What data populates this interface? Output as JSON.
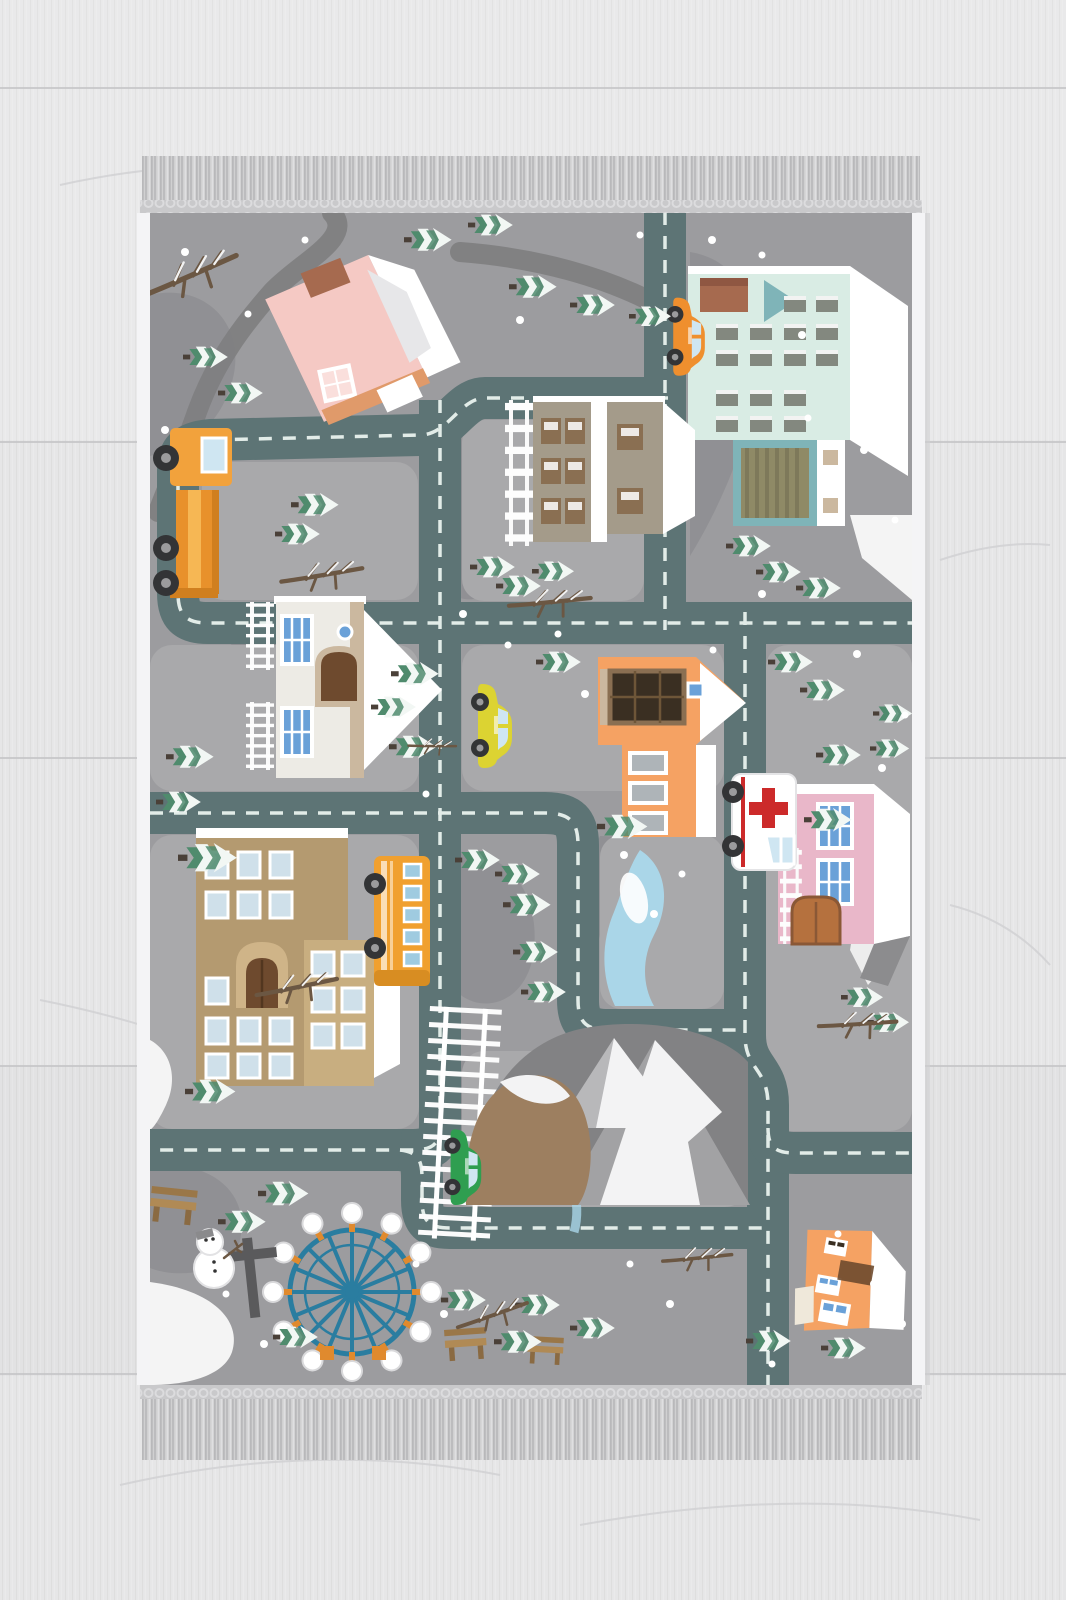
{
  "meta": {
    "scene": "Children's winter town road play rug with tasselled fringe, photographed from above on a light wooden plank floor",
    "image_type": "product-photo",
    "visible_text": "none"
  },
  "palette": {
    "floor": "#e6e6e7",
    "floorLine": "#c6c6c8",
    "grain": "#d0d0d2",
    "fringeBase": "#d0d0d1",
    "fringeDark": "#bcbcbe",
    "fringeLight": "#dfdfe1",
    "knotBand": "#c9c9cb",
    "rugEdge": "#f4f4f6",
    "rugBg": "#9c9c9f",
    "block": "#a9a9ab",
    "terrain": "#86868a",
    "snow": "#f4f4f4",
    "road": "#5d7475",
    "roadDash": "#e2ece8",
    "path": "#7f7f81",
    "treeGreen": "#4f8b6d",
    "treeWhite": "#f2f7f4",
    "trunk": "#4a4038",
    "branch": "#6b5743",
    "pinkHouse": "#f5c9c4",
    "pinkRoof": "#fadfdc",
    "trim": "#e09a6a",
    "chimney": "#a66a4f",
    "mint": "#d9ece4",
    "mintWin": "#83887f",
    "teal": "#7fb4b8",
    "garage": "#8f8a66",
    "tan": "#a49b8a",
    "tanWin": "#8a6f52",
    "churchWall": "#edebe5",
    "churchTan": "#cbb89f",
    "door": "#6e4a2e",
    "winBlue": "#6aa1d8",
    "orangeHouse": "#f5a263",
    "darkWin": "#3a2f22",
    "pink2": "#e9b7c9",
    "clinicDoor": "#b5713e",
    "school": "#b49a70",
    "schoolLight": "#c8ae80",
    "schoolWin": "#cfe0ea",
    "bus": "#f0a02f",
    "taxi": "#dcd332",
    "orangeCar": "#ef8f2e",
    "green": "#2f9e50",
    "red": "#cc2a2a",
    "glass": "#cfe6f2",
    "ferris": "#2a7da0",
    "podArm": "#e08a2e",
    "river": "#aad6e8",
    "mountain": "#a2a2a4",
    "mountainDark": "#828284",
    "hill": "#9d7f60",
    "bench": "#b08a55",
    "benchDark": "#8a6a42",
    "wheel": "#333436",
    "hub": "#9b9b9d",
    "post": "#5a5a5c"
  },
  "rug": {
    "x": 137,
    "y": 156,
    "width": 788,
    "height": 1306,
    "fringe": [
      "top",
      "bottom"
    ],
    "selvedge": "white rolled edge on left and right sides",
    "theme": "winter road map town"
  },
  "inventory": {
    "buildings": [
      {
        "name": "pink-cottage",
        "area": "top-left",
        "colors": [
          "pinkHouse",
          "pinkRoof",
          "chimney"
        ]
      },
      {
        "name": "mint-apartment",
        "area": "top-right",
        "details": "rows of dark windows, teal gable, brown chimney, striped garage"
      },
      {
        "name": "tan-apartment",
        "area": "upper-center",
        "details": "white ladder fence at left"
      },
      {
        "name": "church",
        "area": "mid-left",
        "details": "blue windows, brown arched door, white gable"
      },
      {
        "name": "orange-house",
        "area": "center",
        "details": "large dark attic window, three stacked windows"
      },
      {
        "name": "pink-clinic",
        "area": "mid-right",
        "details": "blue windows, brown double door, white ladder"
      },
      {
        "name": "school-building",
        "area": "bottom-left",
        "details": "tan facade, arched entry, many light windows"
      },
      {
        "name": "orange-cottage",
        "area": "bottom-right",
        "details": "tilted, white roof"
      }
    ],
    "vehicles": [
      {
        "name": "orange-car",
        "area": "top, vertical road"
      },
      {
        "name": "crane-truck",
        "area": "left, orange with stripe"
      },
      {
        "name": "yellow-taxi",
        "area": "center vertical road"
      },
      {
        "name": "ambulance",
        "area": "right of center, red cross"
      },
      {
        "name": "school-bus",
        "area": "lower-left vertical road"
      },
      {
        "name": "green-car",
        "area": "bottom-center beside railroad"
      }
    ],
    "landmarks": [
      "snowy-mountains",
      "brown-hill",
      "river",
      "railroad-track",
      "ferris-wheel",
      "snowman",
      "benches",
      "signpost",
      "dirt-path",
      "bare-branches",
      "pine-trees",
      "snow-dots",
      "snow-patches"
    ],
    "counts": {
      "pine_trees": 46,
      "bare_branches": 8,
      "snow_dots": 37,
      "benches": 3
    },
    "roads": "dark slate-teal loops with white dashed centerlines entering the rug at top, left, right and bottom edges"
  }
}
